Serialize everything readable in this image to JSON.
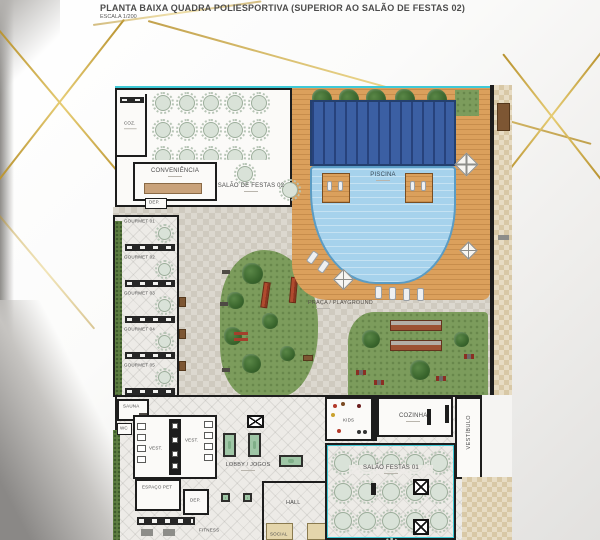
{
  "header": {
    "title": "PLANTA BAIXA QUADRA POLIESPORTIVA (SUPERIOR AO SALÃO DE FESTAS 02)",
    "scale": "ESCALA 1/200"
  },
  "plan": {
    "salao_festas_02": {
      "label": "SALÃO DE FESTAS 02",
      "tables": 15
    },
    "coz": {
      "label": "COZ."
    },
    "conveniencia": {
      "label": "CONVENIÊNCIA"
    },
    "dep_top": {
      "label": "DEP."
    },
    "gourmet": [
      {
        "label": "GOURMET 01"
      },
      {
        "label": "GOURMET 02"
      },
      {
        "label": "GOURMET 03"
      },
      {
        "label": "GOURMET 04"
      },
      {
        "label": "GOURMET 05"
      }
    ],
    "piscina": {
      "label": "PISCINA"
    },
    "praca": {
      "label": "PRAÇA / PLAYGROUND"
    },
    "sauna": {
      "label": "SAUNA"
    },
    "wc": {
      "label": "WC"
    },
    "vest_1": {
      "label": "VEST."
    },
    "vest_2": {
      "label": "VEST."
    },
    "espaco_pet": {
      "label": "ESPAÇO PET"
    },
    "dep_bottom": {
      "label": "DEP."
    },
    "fitness": {
      "label": "FITNESS"
    },
    "lobby_jogos": {
      "label": "LOBBY / JOGOS"
    },
    "hall": {
      "label": "HALL"
    },
    "social": {
      "label": "SOCIAL"
    },
    "kids": {
      "label": "KIDS"
    },
    "cozinha": {
      "label": "COZINHA"
    },
    "vestibulo": {
      "label": "VESTÍBULO"
    },
    "salao_festas_01": {
      "label": "SALÃO FESTAS 01",
      "tables": 16
    }
  },
  "colors": {
    "gold": "#c9a44a",
    "pool_dark": "#3b5fa3",
    "pool_light": "#a6d2ec",
    "deck": "#dba05c",
    "lawn": "#7c9c5c",
    "wall": "#1d1d1d",
    "accent_teal": "#3ec9d6"
  }
}
